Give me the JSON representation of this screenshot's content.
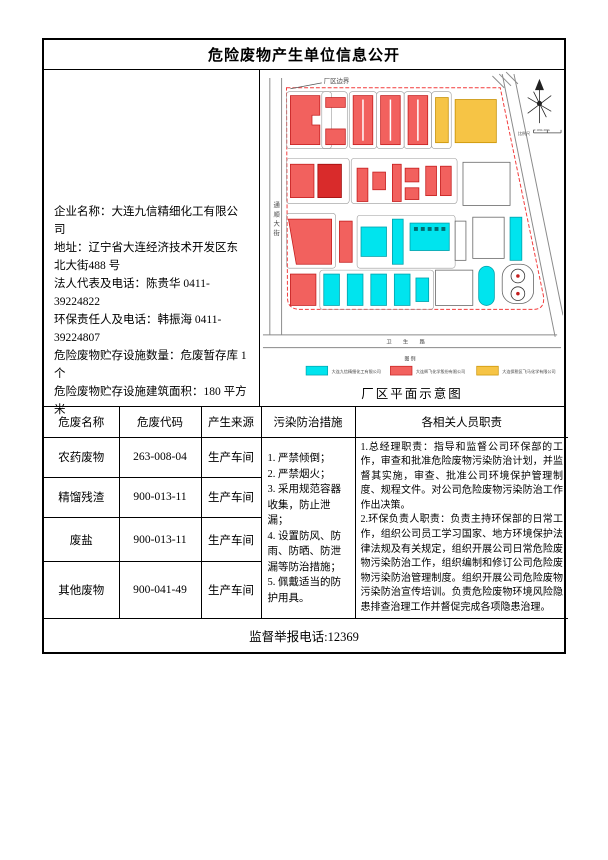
{
  "title": "危险废物产生单位信息公开",
  "company": {
    "lines": [
      "企业名称：大连九信精细化工有限公司",
      "地址：辽宁省大连经济技术开发区东北大街488 号",
      "法人代表及电话：陈贵华 0411-39224822",
      "环保责任人及电话：韩振海 0411-39224807",
      "危险废物贮存设施数量：危废暂存库 1 个",
      "危险废物贮存设施建筑面积：180 平方米"
    ]
  },
  "site_plan": {
    "boundary_label": "厂区边界",
    "left_road_label": "通顺大街",
    "bottom_road_label": "卫 生 路",
    "scale_label": "比例尺",
    "scale_ticks": "0   10m   20m",
    "legend_title": "图  例",
    "legend": [
      {
        "color": "#00E4EE",
        "label": "大连九信精细化工有限公司"
      },
      {
        "color": "#F2615E",
        "label": "大连辉飞化学股份有限公司"
      },
      {
        "color": "#F6C445",
        "label": "大连保税区飞马化学有限公司"
      }
    ],
    "caption": "厂区平面示意图"
  },
  "waste_table": {
    "headers": [
      "危废名称",
      "危废代码",
      "产生来源",
      "污染防治措施",
      "各相关人员职责"
    ],
    "rows": [
      {
        "name": "农药废物",
        "code": "263-008-04",
        "source": "生产车间"
      },
      {
        "name": "精馏残渣",
        "code": "900-013-11",
        "source": "生产车间"
      },
      {
        "name": "废盐",
        "code": "900-013-11",
        "source": "生产车间"
      },
      {
        "name": "其他废物",
        "code": "900-041-49",
        "source": "生产车间"
      }
    ],
    "measures": "1. 严禁倾倒；\n2. 严禁烟火；\n3. 采用规范容器收集，防止泄漏；\n4. 设置防风、防雨、防晒、防泄漏等防治措施；\n5. 佩戴适当的防护用具。",
    "responsibilities": "1.总经理职责：指导和监督公司环保部的工作，审查和批准危险废物污染防治计划，并监督其实施，审查、批准公司环境保护管理制度、规程文件。对公司危险废物污染防治工作作出决策。\n2.环保负责人职责：负责主持环保部的日常工作，组织公司员工学习国家、地方环境保护法律法规及有关规定，组织开展公司日常危险废物污染防治工作，组织编制和修订公司危险废物污染防治管理制度。组织开展公司危险废物污染防治宣传培训。负责危险废物环境风险隐患排查治理工作并督促完成各项隐患治理。"
  },
  "footer": {
    "hotline": "监督举报电话:12369"
  }
}
